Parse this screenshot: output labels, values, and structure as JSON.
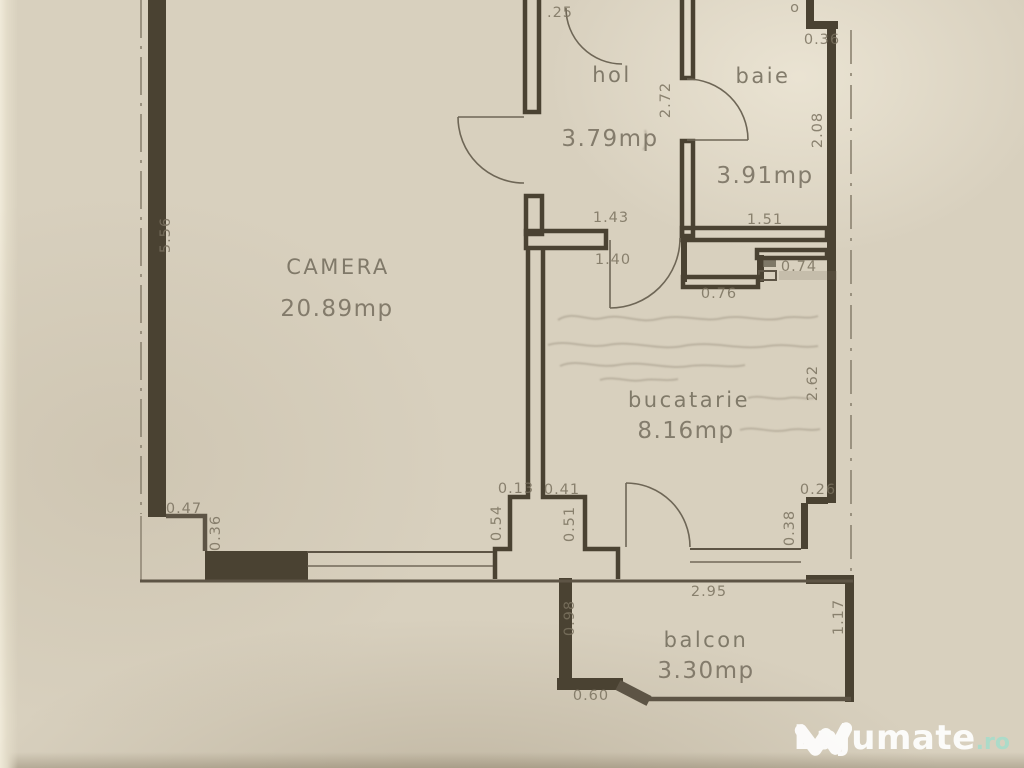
{
  "document": {
    "kind": "apartment floor plan (scanned)"
  },
  "rooms": [
    {
      "id": "camera",
      "name": "CAMERA",
      "area": "20.89mp"
    },
    {
      "id": "hol",
      "name": "hol",
      "area": "3.79mp"
    },
    {
      "id": "baie",
      "name": "baie",
      "area": "3.91mp"
    },
    {
      "id": "bucatarie",
      "name": "bucatarie",
      "area": "8.16mp"
    },
    {
      "id": "balcon",
      "name": "balcon",
      "area": "3.30mp"
    }
  ],
  "dims": {
    "left_height": "5.56",
    "entry_top": ".25",
    "top_fragment": "o",
    "hol_height": "2.72",
    "notch_width": "0.36",
    "baie_right_height": "2.08",
    "baie_width": "1.51",
    "hol_opening_top": "1.43",
    "hol_opening_bottom": "1.40",
    "kitchen_top_right_width": "0.74",
    "kitchen_top_left_width": "0.76",
    "kitchen_right_height": "2.62",
    "kitchen_step_width": "0.26",
    "kitchen_step_height": "0.38",
    "pier_top_left": "0.13",
    "pier_top_right": "0.41",
    "pier_left_height": "0.54",
    "pier_right_height": "0.51",
    "camera_step_width": "0.47",
    "camera_step_height": "0.36",
    "balcony_width": "2.95",
    "balcony_left_height": "0.98",
    "balcony_bottom_left": "0.60",
    "balcony_right_height": "1.17"
  },
  "watermark": {
    "brand": "Lajumate",
    "tld": ".ro"
  },
  "colors": {
    "paper": "#d8d0be",
    "wall": "#4a4232",
    "thin_line": "#5d5445",
    "text": "#7b7260",
    "watermark_brand": "#ffffff",
    "watermark_tld": "#a9dccb"
  }
}
